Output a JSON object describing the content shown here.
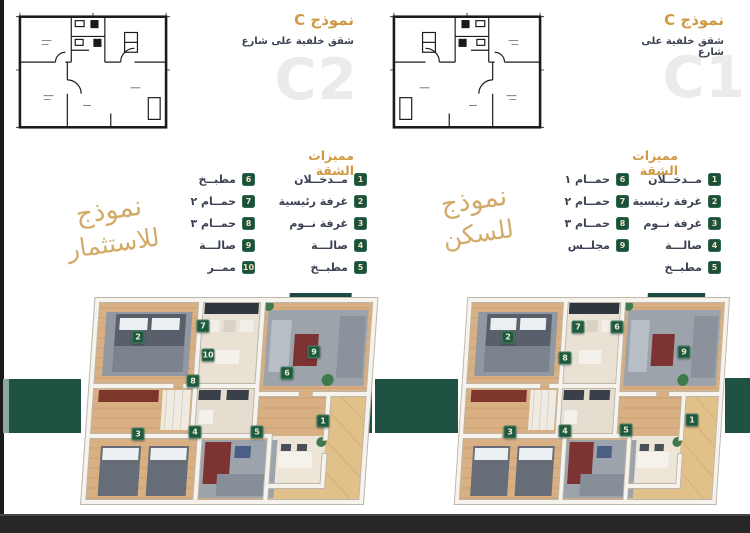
{
  "colors": {
    "accent_gold": "#cf9a44",
    "ribbon_gold": "#cfa45f",
    "text_dark": "#3b4254",
    "badge_green": "#1d4f3d",
    "marker_green": "#1d5a3f",
    "ribbon_green": "#1f5243",
    "watermark_gray": "#ebebeb",
    "bottom_bar": "#272727"
  },
  "panels": [
    {
      "code": "C2",
      "model_title": "نموذج C",
      "model_subtitle": "شقق خلفية على شارع",
      "watermark": "C2",
      "features_title": "مميزات الشقة",
      "ribbon_line1": "نموذج",
      "ribbon_line2": "للاستثمار",
      "features_col1": [
        {
          "num": "1",
          "label": "مــدخــلان"
        },
        {
          "num": "2",
          "label": "غرفة رئيسية"
        },
        {
          "num": "3",
          "label": "غرفة نــوم"
        },
        {
          "num": "4",
          "label": "صالـــة"
        },
        {
          "num": "5",
          "label": "مطبــخ"
        }
      ],
      "features_col2": [
        {
          "num": "6",
          "label": "مطبــخ"
        },
        {
          "num": "7",
          "label": "حمــام ٢"
        },
        {
          "num": "8",
          "label": "حمــام ٣"
        },
        {
          "num": "9",
          "label": "صالـــة"
        },
        {
          "num": "10",
          "label": "ممــر"
        }
      ],
      "markers": [
        {
          "n": "2",
          "x": 60,
          "y": 51
        },
        {
          "n": "7",
          "x": 125,
          "y": 40
        },
        {
          "n": "10",
          "x": 130,
          "y": 69
        },
        {
          "n": "8",
          "x": 115,
          "y": 95
        },
        {
          "n": "6",
          "x": 209,
          "y": 87
        },
        {
          "n": "9",
          "x": 236,
          "y": 66
        },
        {
          "n": "3",
          "x": 60,
          "y": 148
        },
        {
          "n": "4",
          "x": 117,
          "y": 146
        },
        {
          "n": "5",
          "x": 179,
          "y": 146
        },
        {
          "n": "1",
          "x": 245,
          "y": 135
        }
      ]
    },
    {
      "code": "C1",
      "model_title": "نموذج C",
      "model_subtitle": "شقق خلفية على شارع",
      "watermark": "C1",
      "features_title": "مميزات الشقة",
      "ribbon_line1": "نموذج",
      "ribbon_line2": "للسكن",
      "features_col1": [
        {
          "num": "1",
          "label": "مــدخــلان"
        },
        {
          "num": "2",
          "label": "غرفة رئيسية"
        },
        {
          "num": "3",
          "label": "غرفة نــوم"
        },
        {
          "num": "4",
          "label": "صالـــة"
        },
        {
          "num": "5",
          "label": "مطبــخ"
        }
      ],
      "features_col2": [
        {
          "num": "6",
          "label": "حمــام ١"
        },
        {
          "num": "7",
          "label": "حمــام ٢"
        },
        {
          "num": "8",
          "label": "حمــام ٣"
        },
        {
          "num": "9",
          "label": "مجلــس"
        }
      ],
      "markers": [
        {
          "n": "2",
          "x": 56,
          "y": 51
        },
        {
          "n": "7",
          "x": 126,
          "y": 41
        },
        {
          "n": "6",
          "x": 165,
          "y": 41
        },
        {
          "n": "8",
          "x": 113,
          "y": 72
        },
        {
          "n": "9",
          "x": 232,
          "y": 66
        },
        {
          "n": "3",
          "x": 58,
          "y": 146
        },
        {
          "n": "4",
          "x": 113,
          "y": 145
        },
        {
          "n": "5",
          "x": 174,
          "y": 144
        },
        {
          "n": "1",
          "x": 240,
          "y": 134
        }
      ]
    }
  ]
}
